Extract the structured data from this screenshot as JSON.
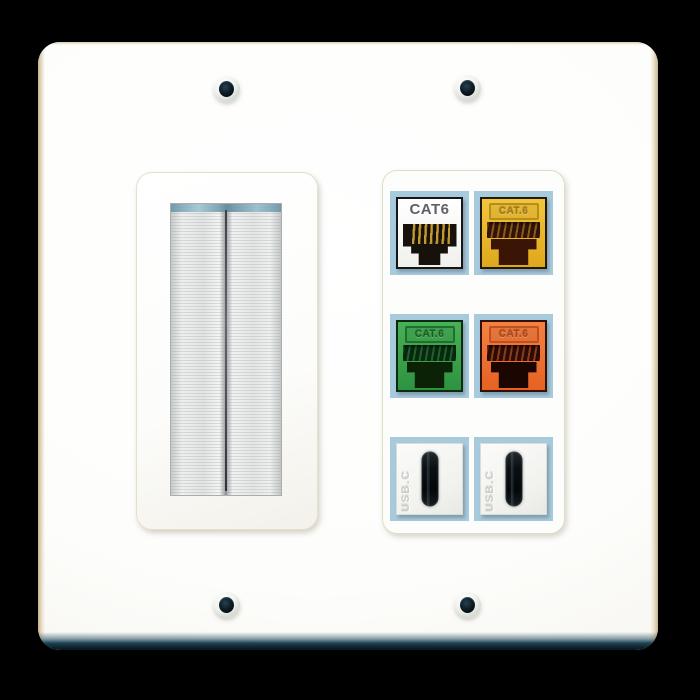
{
  "scene": {
    "background_color": "#000000"
  },
  "wall_plate": {
    "plate_color": "#fcfcf9",
    "edge_tint": "#c9b690",
    "bottom_bevel_color": "#123140",
    "screws": {
      "count": 4
    },
    "modules": {
      "left": {
        "name": "brush-cable-passthrough",
        "bristle_color": "#e8eae9",
        "bristle_tip_tint": "#7fa8bc"
      },
      "right": {
        "name": "keystone-port-panel",
        "cell_border_color": "#a7cadd",
        "ports": [
          {
            "id": "cat6-white",
            "label": "CAT6",
            "face_color": "#f6f6f3",
            "opening": "rj45",
            "pin_color": "#c49a2f"
          },
          {
            "id": "cat6-yellow",
            "label": "CAT.6",
            "face_color": "#e9b226",
            "opening": "rj45"
          },
          {
            "id": "cat6-green",
            "label": "CAT.6",
            "face_color": "#3da54b",
            "opening": "rj45"
          },
          {
            "id": "cat6-orange",
            "label": "CAT.6",
            "face_color": "#ee7133",
            "opening": "rj45"
          },
          {
            "id": "usb-c-1",
            "label": "USB.C",
            "face_color": "#f3f3f0",
            "opening": "usb-c"
          },
          {
            "id": "usb-c-2",
            "label": "USB.C",
            "face_color": "#f3f3f0",
            "opening": "usb-c"
          }
        ]
      }
    }
  }
}
